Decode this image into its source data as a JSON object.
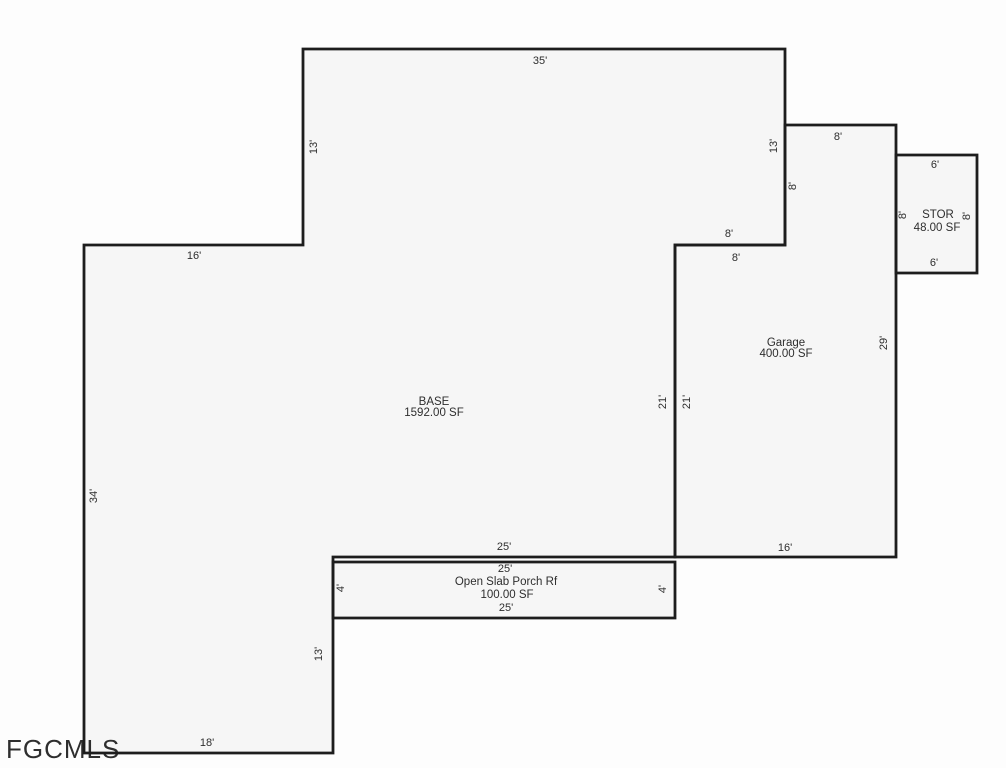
{
  "canvas": {
    "width": 1006,
    "height": 768,
    "background": "#fdfdfd"
  },
  "style": {
    "wall_color": "#1d1d1d",
    "wall_width": 2.8,
    "room_fill": "#f6f6f6",
    "dim_color": "#2e2e2e",
    "dim_font_size": 11,
    "area_font_size": 11.5
  },
  "watermark": {
    "text": "FGCMLS",
    "x": 6,
    "y": 758,
    "font_size": 26,
    "color": "#9e9e9e"
  },
  "structures": [
    {
      "name": "porch",
      "label": "Open Slab Porch Rf",
      "area": "100.00 SF",
      "points": [
        [
          333,
          562
        ],
        [
          675,
          562
        ],
        [
          675,
          618
        ],
        [
          333,
          618
        ]
      ],
      "labels": [
        {
          "text": "Open Slab Porch Rf",
          "x": 506,
          "y": 585
        },
        {
          "text": "100.00 SF",
          "x": 507,
          "y": 598
        }
      ]
    },
    {
      "name": "base",
      "label": "BASE",
      "area": "1592.00 SF",
      "points": [
        [
          303,
          49
        ],
        [
          785,
          49
        ],
        [
          785,
          245
        ],
        [
          675,
          245
        ],
        [
          675,
          557
        ],
        [
          333,
          557
        ],
        [
          333,
          753
        ],
        [
          84,
          753
        ],
        [
          84,
          245
        ],
        [
          303,
          245
        ]
      ],
      "labels": [
        {
          "text": "BASE",
          "x": 434,
          "y": 405
        },
        {
          "text": "1592.00 SF",
          "x": 434,
          "y": 416
        }
      ]
    },
    {
      "name": "garage",
      "label": "Garage",
      "area": "400.00 SF",
      "points": [
        [
          785,
          125
        ],
        [
          896,
          125
        ],
        [
          896,
          557
        ],
        [
          675,
          557
        ],
        [
          675,
          245
        ],
        [
          785,
          245
        ]
      ],
      "labels": [
        {
          "text": "Garage",
          "x": 786,
          "y": 346
        },
        {
          "text": "400.00 SF",
          "x": 786,
          "y": 357
        }
      ]
    },
    {
      "name": "storage",
      "label": "STOR",
      "area": "48.00 SF",
      "points": [
        [
          896,
          155
        ],
        [
          977,
          155
        ],
        [
          977,
          273
        ],
        [
          896,
          273
        ]
      ],
      "labels": [
        {
          "text": "STOR",
          "x": 938,
          "y": 218
        },
        {
          "text": "48.00 SF",
          "x": 937,
          "y": 231
        }
      ]
    }
  ],
  "dimensions": [
    {
      "text": "35'",
      "x": 540,
      "y": 64,
      "rotate": 0
    },
    {
      "text": "13'",
      "x": 317,
      "y": 147,
      "rotate": -90
    },
    {
      "text": "13'",
      "x": 777,
      "y": 146,
      "rotate": -90
    },
    {
      "text": "16'",
      "x": 194,
      "y": 259,
      "rotate": 0
    },
    {
      "text": "34'",
      "x": 97,
      "y": 496,
      "rotate": -90
    },
    {
      "text": "18'",
      "x": 207,
      "y": 746,
      "rotate": 0
    },
    {
      "text": "13'",
      "x": 322,
      "y": 654,
      "rotate": -90
    },
    {
      "text": "8'",
      "x": 838,
      "y": 140,
      "rotate": 0
    },
    {
      "text": "8'",
      "x": 796,
      "y": 186,
      "rotate": -90
    },
    {
      "text": "8'",
      "x": 729,
      "y": 237,
      "rotate": 0
    },
    {
      "text": "8'",
      "x": 736,
      "y": 261,
      "rotate": 0
    },
    {
      "text": "21'",
      "x": 666,
      "y": 402,
      "rotate": -90
    },
    {
      "text": "21'",
      "x": 690,
      "y": 402,
      "rotate": -90
    },
    {
      "text": "29'",
      "x": 887,
      "y": 343,
      "rotate": -90
    },
    {
      "text": "16'",
      "x": 785,
      "y": 551,
      "rotate": 0
    },
    {
      "text": "25'",
      "x": 504,
      "y": 550,
      "rotate": 0
    },
    {
      "text": "25'",
      "x": 505,
      "y": 572,
      "rotate": 0
    },
    {
      "text": "25'",
      "x": 506,
      "y": 611,
      "rotate": 0
    },
    {
      "text": "4'",
      "x": 344,
      "y": 588,
      "rotate": -90
    },
    {
      "text": "4'",
      "x": 666,
      "y": 589,
      "rotate": -90
    },
    {
      "text": "6'",
      "x": 935,
      "y": 168,
      "rotate": 0
    },
    {
      "text": "6'",
      "x": 934,
      "y": 266,
      "rotate": 0
    },
    {
      "text": "8'",
      "x": 906,
      "y": 215,
      "rotate": -90
    },
    {
      "text": "8'",
      "x": 970,
      "y": 216,
      "rotate": -90
    }
  ]
}
